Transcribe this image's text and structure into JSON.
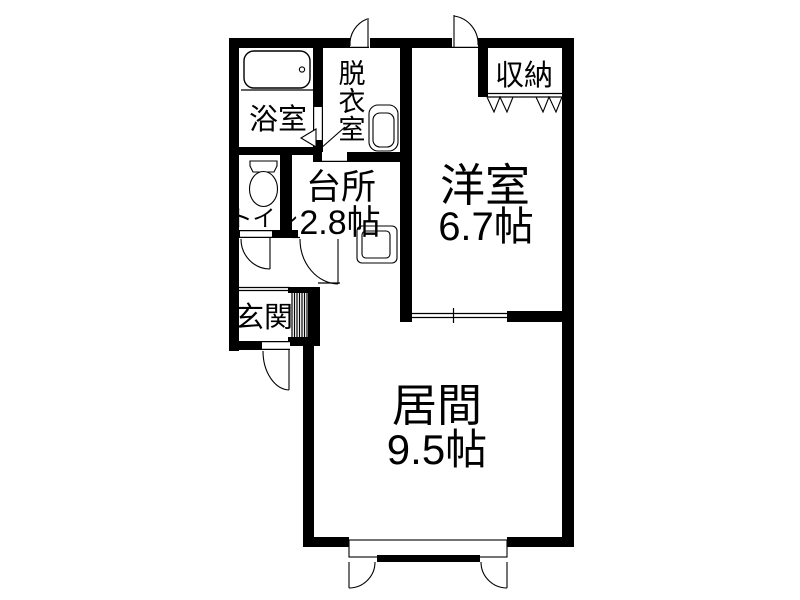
{
  "floorplan": {
    "rooms": {
      "bathroom": {
        "label": "浴室"
      },
      "dressing_room": {
        "label": "脱衣室",
        "chars": [
          "脱",
          "衣",
          "室"
        ]
      },
      "storage": {
        "label": "収納"
      },
      "western_room": {
        "label": "洋室",
        "size": "6.7帖"
      },
      "toilet": {
        "label": "トイレ"
      },
      "kitchen": {
        "label": "台所",
        "size": "2.8帖"
      },
      "entrance": {
        "label": "玄関"
      },
      "living_room": {
        "label": "居間",
        "size": "9.5帖"
      }
    },
    "colors": {
      "wall": "#000000",
      "background": "#ffffff",
      "text": "#000000"
    }
  }
}
